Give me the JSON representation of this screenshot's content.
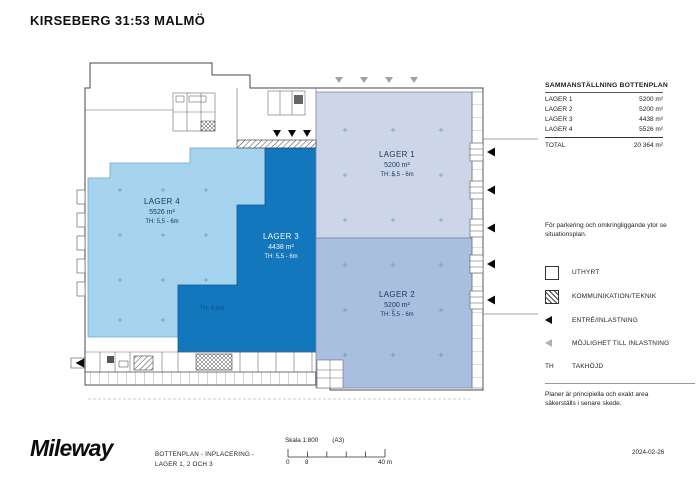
{
  "title": "KIRSEBERG 31:53 MALMÖ",
  "summary": {
    "heading": "SAMMANSTÄLLNING BOTTENPLAN",
    "rows": [
      {
        "label": "LAGER 1",
        "value": "5200 m²"
      },
      {
        "label": "LAGER 2",
        "value": "5200 m²"
      },
      {
        "label": "LAGER 3",
        "value": "4438 m²"
      },
      {
        "label": "LAGER 4",
        "value": "5526 m²"
      }
    ],
    "total_label": "TOTAL",
    "total_value": "20 364 m²"
  },
  "notes": {
    "parking": "För parkering och omkringliggande ytor se situationsplan.",
    "disclaimer": "Planer är principiella och exakt area säkerställs i senare skede."
  },
  "legend": {
    "uthyrt": "UTHYRT",
    "kommunikation": "KOMMUNIKATION/TEKNIK",
    "entre": "ENTRÉ/INLASTNING",
    "mojlighet": "MÖJLIGHET TILL INLASTNING",
    "th_symbol": "TH",
    "takhojd": "TAKHÖJD"
  },
  "plan": {
    "areas": [
      {
        "name": "LAGER 1",
        "area": "5200 m²",
        "th": "TH: 5,5 - 6m"
      },
      {
        "name": "LAGER 2",
        "area": "5200 m²",
        "th": "TH: 5,5 - 6m"
      },
      {
        "name": "LAGER 3",
        "area": "4438 m²",
        "th": "TH: 5,5 - 6m"
      },
      {
        "name": "LAGER 4",
        "area": "5526 m²",
        "th": "TH: 5,5 - 6m"
      }
    ],
    "extra_th": "TH: 6,5m",
    "colors": {
      "lager1": "#cdd6e9",
      "lager2": "#a9bfdf",
      "lager3": "#1377be",
      "lager4": "#a6d3ee"
    }
  },
  "footer": {
    "logo": "Mileway",
    "drawing_title_line1": "BOTTENPLAN - INPLACERING -",
    "drawing_title_line2": "LAGER 1, 2 OCH 3",
    "scale_label": "Skala 1:800",
    "paper_size": "(A3)",
    "scale_tick_0": "0",
    "scale_tick_8": "8",
    "scale_tick_40": "40 m",
    "date": "2024-02-26"
  }
}
